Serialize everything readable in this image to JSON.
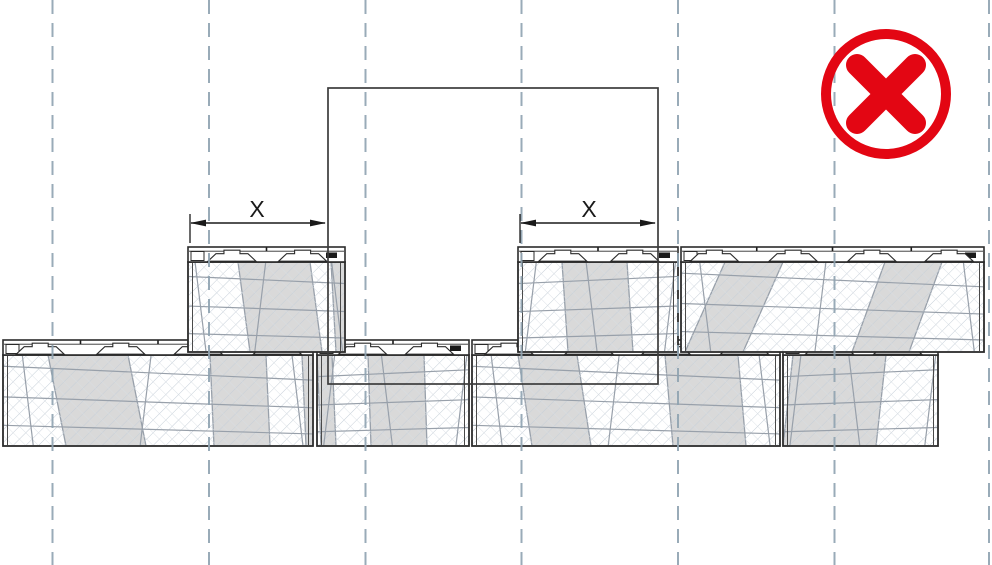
{
  "scene": {
    "width": 992,
    "height": 565,
    "background": "#ffffff"
  },
  "colors": {
    "block_outline": "#2b2b2b",
    "inner_edge": "#4a4a4a",
    "hatch_primary": "#c6cfd8",
    "hatch_secondary": "#d8dee4",
    "stone_line": "#98a0aa",
    "patch_fill": "#d9d9d9",
    "cap_fill": "#ffffff",
    "body_fill": "#ffffff",
    "centerline": "#8fa3b1",
    "outline_rect": "#3c3c3c",
    "dimension": "#1a1a1a",
    "prohibited_red": "#e30613"
  },
  "centerlines": {
    "xs": [
      52.5,
      209,
      365.5,
      521.5,
      678,
      834.5,
      989
    ],
    "dash": "14 9",
    "width": 2
  },
  "outline_rect": {
    "x": 328,
    "y": 88,
    "width": 330,
    "height": 296
  },
  "courses": [
    {
      "id": "bottom-course",
      "cap_top": 340,
      "cap_height": 15,
      "body_bottom": 446,
      "blocks": [
        {
          "x": 3,
          "width": 310,
          "knobs": [
            0.12,
            0.38,
            0.63,
            0.885
          ],
          "ticks": [
            0.25,
            0.5,
            0.76
          ],
          "patches": [
            [
              48,
              128,
              18
            ],
            [
              210,
              266,
              4
            ],
            [
              302,
              313,
              4
            ]
          ]
        },
        {
          "x": 317,
          "width": 152,
          "knobs": [
            0.3,
            0.74
          ],
          "ticks": [
            0.5
          ],
          "patches": [
            [
              317,
              332,
              4
            ],
            [
              368,
              424,
              3
            ]
          ]
        },
        {
          "x": 472,
          "width": 308,
          "knobs": [
            0.12,
            0.38,
            0.63,
            0.885
          ],
          "ticks": [
            0.25,
            0.5,
            0.76
          ],
          "patches": [
            [
              518,
              577,
              14
            ],
            [
              665,
              738,
              8
            ]
          ]
        },
        {
          "x": 783,
          "width": 155,
          "knobs": [
            0.3,
            0.74
          ],
          "ticks": [
            0.5
          ],
          "patches": [
            [
              793,
              886,
              -10
            ]
          ]
        }
      ]
    },
    {
      "id": "top-course",
      "cap_top": 247,
      "cap_height": 15,
      "body_bottom": 352,
      "blocks": [
        {
          "x": 188,
          "width": 157,
          "knobs": [
            0.28,
            0.73
          ],
          "ticks": [
            0.5
          ],
          "patches": [
            [
              238,
              310,
              12
            ],
            [
              331,
              345,
              5
            ]
          ]
        },
        {
          "x": 518,
          "width": 160,
          "knobs": [
            0.28,
            0.73
          ],
          "ticks": [
            0.5
          ],
          "patches": [
            [
              562,
              627,
              6
            ]
          ]
        },
        {
          "x": 681,
          "width": 303,
          "knobs": [
            0.11,
            0.37,
            0.63,
            0.885
          ],
          "ticks": [
            0.25,
            0.5,
            0.76
          ],
          "patches": [
            [
              725,
              783,
              -40
            ],
            [
              885,
              942,
              -33
            ]
          ]
        }
      ]
    }
  ],
  "dimensions": [
    {
      "label": "X",
      "y": 223,
      "x1": 190,
      "x2": 326,
      "tick_x": 190,
      "label_x": 257,
      "label_y": 217
    },
    {
      "label": "X",
      "y": 223,
      "x1": 520,
      "x2": 656,
      "tick_x": 520,
      "label_x": 589,
      "label_y": 217
    }
  ],
  "prohibited_icon": {
    "name": "crossed-circle",
    "cx": 886,
    "cy": 94,
    "ring_radius": 60,
    "ring_stroke_width": 10,
    "cross_half_extent": 29,
    "cross_stroke_width": 22
  }
}
